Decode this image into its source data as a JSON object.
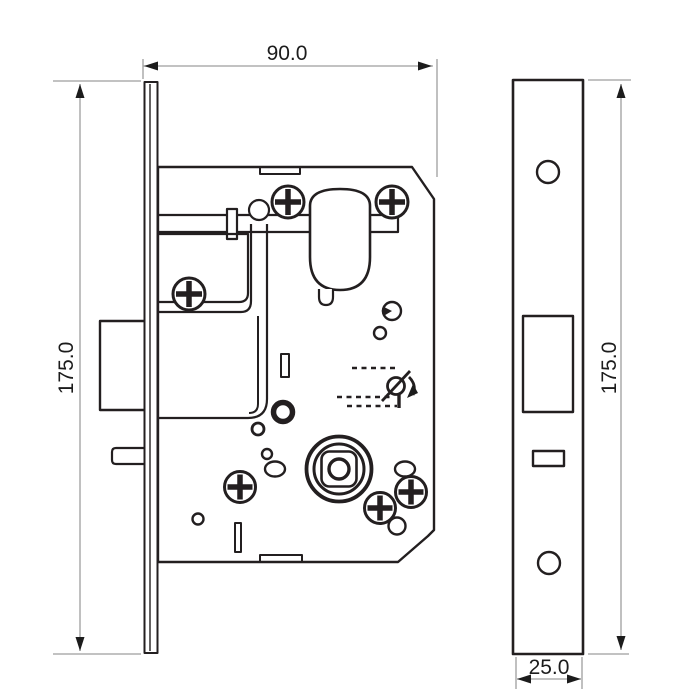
{
  "drawing": {
    "kind": "technical-drawing",
    "subject": "mortise-lock",
    "views": [
      "front",
      "side"
    ]
  },
  "dimensions": {
    "front_width": {
      "label": "90.0"
    },
    "front_height": {
      "label": "175.0"
    },
    "side_height": {
      "label": "175.0"
    },
    "faceplate_width": {
      "label": "25.0"
    }
  },
  "colors": {
    "line": "#231f20",
    "dimension_line": "#9e9e9e",
    "text": "#1c1c1c",
    "background": "#ffffff"
  },
  "icons": [
    "phillips-screw-icon",
    "key-disabled-icon",
    "spindle-hub-icon",
    "latch-bolt",
    "cylinder-follower"
  ]
}
